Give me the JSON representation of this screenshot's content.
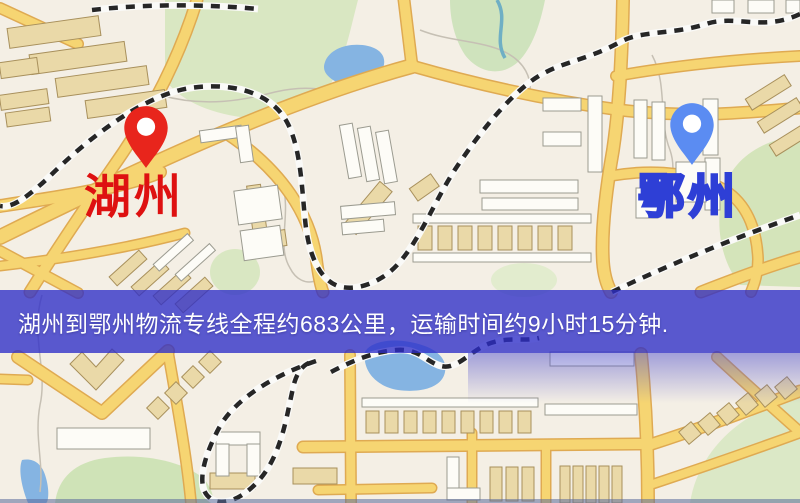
{
  "map": {
    "type": "logistics-route-map",
    "markers": [
      {
        "id": "origin",
        "label": "湖州",
        "pin_color": "#e8251c",
        "pin_style": "red-teardrop-pin",
        "label_style": "solid-red-text"
      },
      {
        "id": "destination",
        "label": "鄂州",
        "pin_color": "#5b8cf2",
        "pin_style": "blue-teardrop-pin",
        "label_style": "white-text-blue-outline"
      }
    ],
    "banner": {
      "text": "湖州到鄂州物流专线全程约683公里，运输时间约9小时15分钟.",
      "background": "rgba(45,45,200,0.78)",
      "text_color": "#ffffff"
    },
    "route_info": {
      "origin": "湖州",
      "destination": "鄂州",
      "distance": "683公里",
      "duration": "9小时15分钟"
    },
    "palette": {
      "land": "#f4efe5",
      "road_fill": "#f6d572",
      "road_casing": "#dfaa52",
      "park_green": "#d9e7c2",
      "water_blue": "#85b4e2",
      "building_tan": "#ead9a8",
      "building_white": "#fdfcf7",
      "railway_dash": "#262626"
    }
  }
}
